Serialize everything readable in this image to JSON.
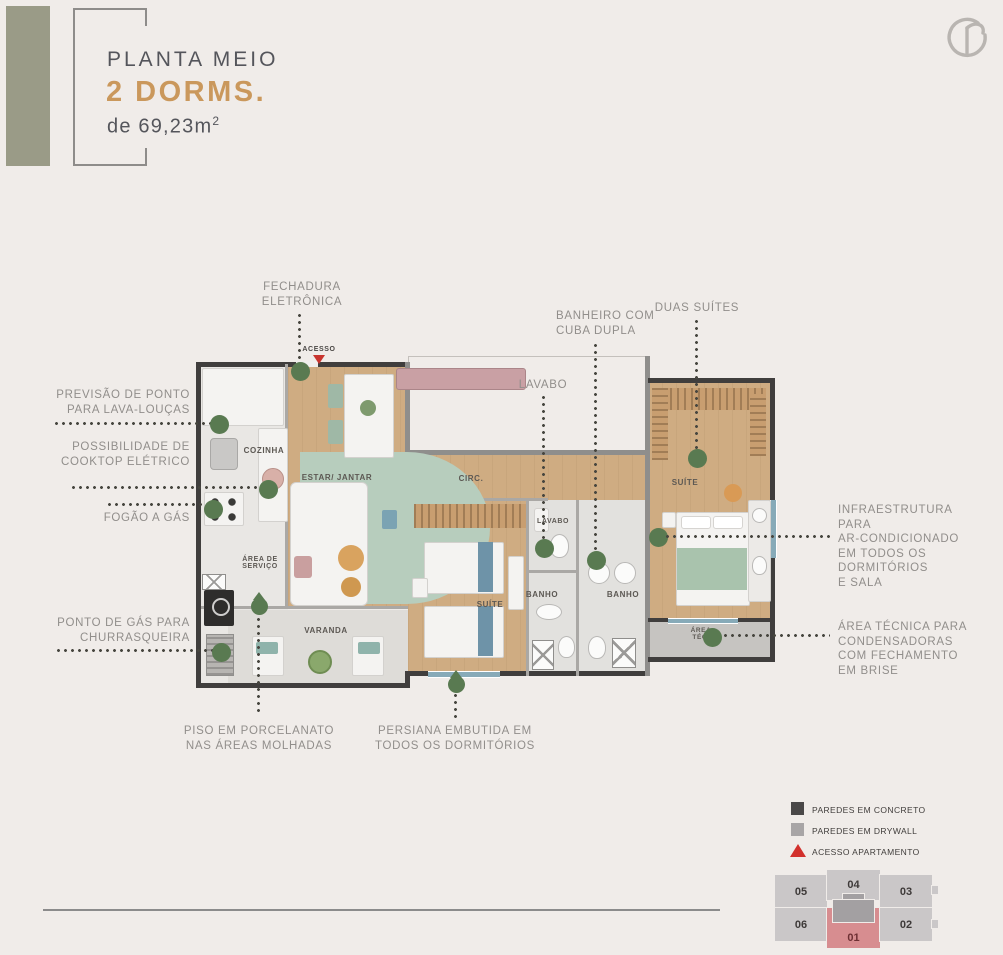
{
  "header": {
    "title_line1": "PLANTA MEIO",
    "title_line2": "2 DORMS.",
    "area_prefix": "de 69,23m",
    "area_sup": "2"
  },
  "plan": {
    "acesso_label": "ACESSO",
    "rooms": {
      "cozinha": "COZINHA",
      "estar_jantar": "ESTAR/ JANTAR",
      "circ": "CIRC.",
      "suite1": "SUÍTE",
      "lavabo": "LAVABO",
      "banho1": "BANHO",
      "banho2": "BANHO",
      "suite2": "SUÍTE",
      "varanda": "VARANDA",
      "area_servico_l1": "ÁREA DE",
      "area_servico_l2": "SERVIÇO",
      "area_tec_l1": "ÁREA",
      "area_tec_l2": "TÉC."
    }
  },
  "callouts": {
    "fechadura": {
      "l1": "FECHADURA",
      "l2": "ELETRÔNICA"
    },
    "previsao": {
      "l1": "PREVISÃO DE PONTO",
      "l2": "PARA LAVA-LOUÇAS"
    },
    "cooktop": {
      "l1": "POSSIBILIDADE DE",
      "l2": "COOKTOP ELÉTRICO"
    },
    "fogao": {
      "l1": "FOGÃO A GÁS"
    },
    "churrasqueira": {
      "l1": "PONTO DE GÁS PARA",
      "l2": "CHURRASQUEIRA"
    },
    "piso": {
      "l1": "PISO EM PORCELANATO",
      "l2": "NAS ÁREAS MOLHADAS"
    },
    "persiana": {
      "l1": "PERSIANA EMBUTIDA EM",
      "l2": "TODOS OS DORMITÓRIOS"
    },
    "lavabo": {
      "l1": "LAVABO"
    },
    "banheiro": {
      "l1": "BANHEIRO COM",
      "l2": "CUBA DUPLA"
    },
    "duas_suites": {
      "l1": "DUAS SUÍTES"
    },
    "infra": {
      "l1": "INFRAESTRUTURA",
      "l2": "PARA",
      "l3": "AR-CONDICIONADO",
      "l4": "EM TODOS OS",
      "l5": "DORMITÓRIOS",
      "l6": "E SALA"
    },
    "area_tecnica": {
      "l1": "ÁREA TÉCNICA PARA",
      "l2": "CONDENSADORAS",
      "l3": "COM FECHAMENTO",
      "l4": "EM BRISE"
    }
  },
  "legend": {
    "items": [
      {
        "label": "PAREDES EM CONCRETO",
        "swatch": "concrete"
      },
      {
        "label": "PAREDES EM DRYWALL",
        "swatch": "drywall"
      },
      {
        "label": "ACESSO APARTAMENTO",
        "swatch": "red-triangle"
      }
    ]
  },
  "keyplan": {
    "units": [
      {
        "id": "05"
      },
      {
        "id": "04"
      },
      {
        "id": "03"
      },
      {
        "id": "06"
      },
      {
        "id": "01"
      },
      {
        "id": "02"
      }
    ],
    "highlighted": "01"
  },
  "colors": {
    "accent_gold": "#ca985c",
    "green_marker": "#597a51",
    "legend_concrete": "#4a4848",
    "legend_drywall": "#a8a5a6",
    "legend_red": "#d2302c",
    "keyplan_unit": "#cac7c8",
    "keyplan_highlight": "#d78d90",
    "olive_bar": "#9a9b87",
    "background": "#f0ece9"
  }
}
